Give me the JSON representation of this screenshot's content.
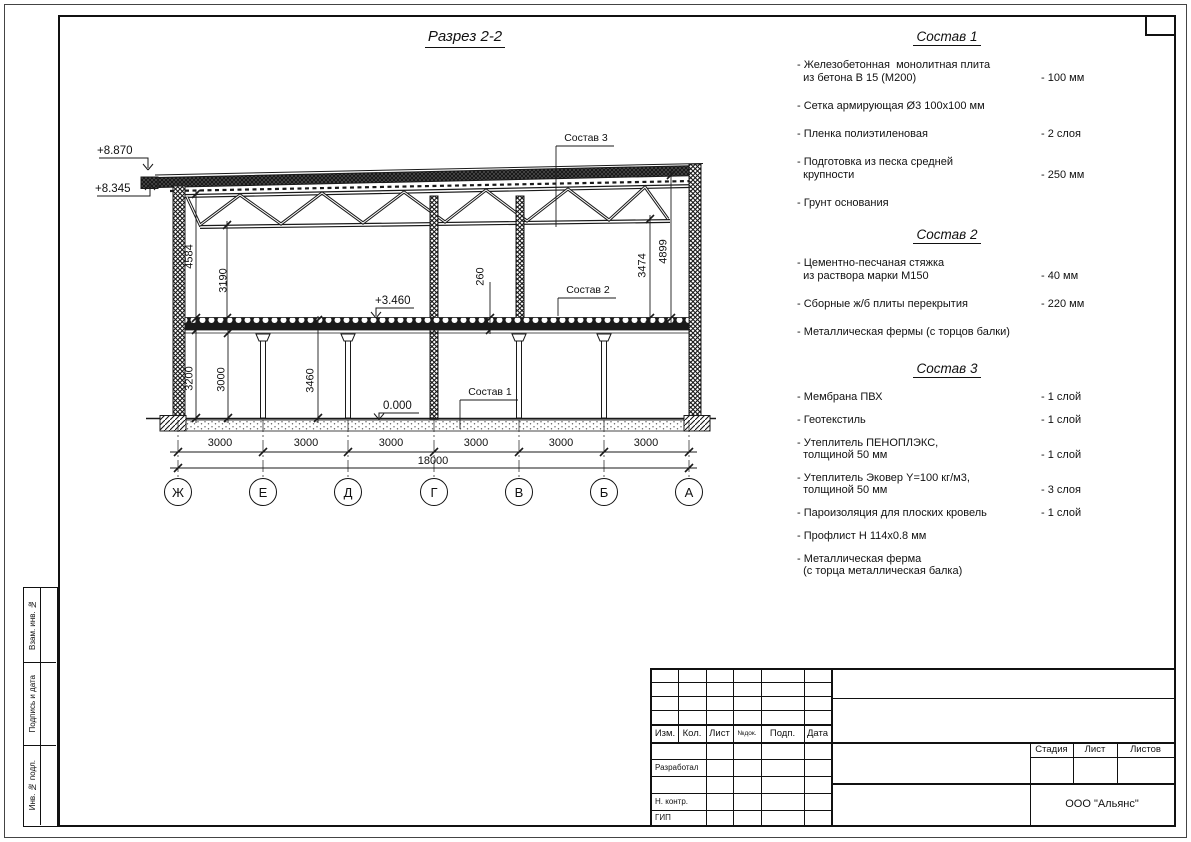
{
  "page": {
    "bg": "#ffffff",
    "line_color": "#1a1a1a"
  },
  "section_view": {
    "title": "Разрез 2-2",
    "elevation_marks": [
      "+8.870",
      "+8.345",
      "+3.460",
      "0.000"
    ],
    "callouts": [
      "Состав 1",
      "Состав 2",
      "Состав 3"
    ],
    "vertical_dims": [
      "4584",
      "3190",
      "260",
      "3474",
      "4899",
      "3200",
      "3000",
      "3460"
    ],
    "bay_dims": [
      "3000",
      "3000",
      "3000",
      "3000",
      "3000",
      "3000"
    ],
    "total_dim": "18000",
    "axes": [
      "Ж",
      "Е",
      "Д",
      "Г",
      "В",
      "Б",
      "А"
    ]
  },
  "specs": [
    {
      "title": "Состав 1",
      "items": [
        {
          "name": "- Железобетонная  монолитная плита\n  из бетона В 15 (М200)",
          "value": "- 100 мм"
        },
        {
          "name": "- Сетка армирующая Ø3 100х100 мм",
          "value": ""
        },
        {
          "name": "- Пленка полиэтиленовая",
          "value": "-  2 слоя"
        },
        {
          "name": "- Подготовка из песка средней\n  крупности",
          "value": "- 250 мм"
        },
        {
          "name": "- Грунт основания",
          "value": ""
        }
      ]
    },
    {
      "title": "Состав 2",
      "items": [
        {
          "name": "- Цементно-песчаная стяжка\n  из раствора марки М150",
          "value": "- 40 мм"
        },
        {
          "name": "- Сборные ж/б плиты перекрытия",
          "value": "- 220 мм"
        },
        {
          "name": "- Металлическая фермы (с торцов балки)",
          "value": ""
        }
      ]
    },
    {
      "title": "Состав 3",
      "items": [
        {
          "name": "- Мембрана ПВХ",
          "value": "- 1 слой"
        },
        {
          "name": "- Геотекстиль",
          "value": "- 1 слой"
        },
        {
          "name": "- Утеплитель ПЕНОПЛЭКС,\n  толщиной 50 мм",
          "value": "- 1 слой"
        },
        {
          "name": "- Утеплитель Эковер Y=100 кг/м3,\n  толщиной 50 мм",
          "value": "- 3 слоя"
        },
        {
          "name": "- Пароизоляция для плоских кровель",
          "value": "- 1 слой"
        },
        {
          "name": "- Профлист Н 114х0.8 мм",
          "value": ""
        },
        {
          "name": "- Металлическая ферма\n  (с торца металлическая балка)",
          "value": ""
        }
      ]
    }
  ],
  "titleblock": {
    "header_cols": [
      "Изм.",
      "Кол.",
      "Лист",
      "№док.",
      "Подп.",
      "Дата"
    ],
    "sign_rows": [
      "Разработал",
      "Н. контр.",
      "ГИП"
    ],
    "stage_cols": [
      "Стадия",
      "Лист",
      "Листов"
    ],
    "company": "ООО \"Альянс\""
  },
  "sidebar": {
    "labels": [
      "Взам. инв. №",
      "Подпись и дата",
      "Инв. № подл."
    ]
  }
}
